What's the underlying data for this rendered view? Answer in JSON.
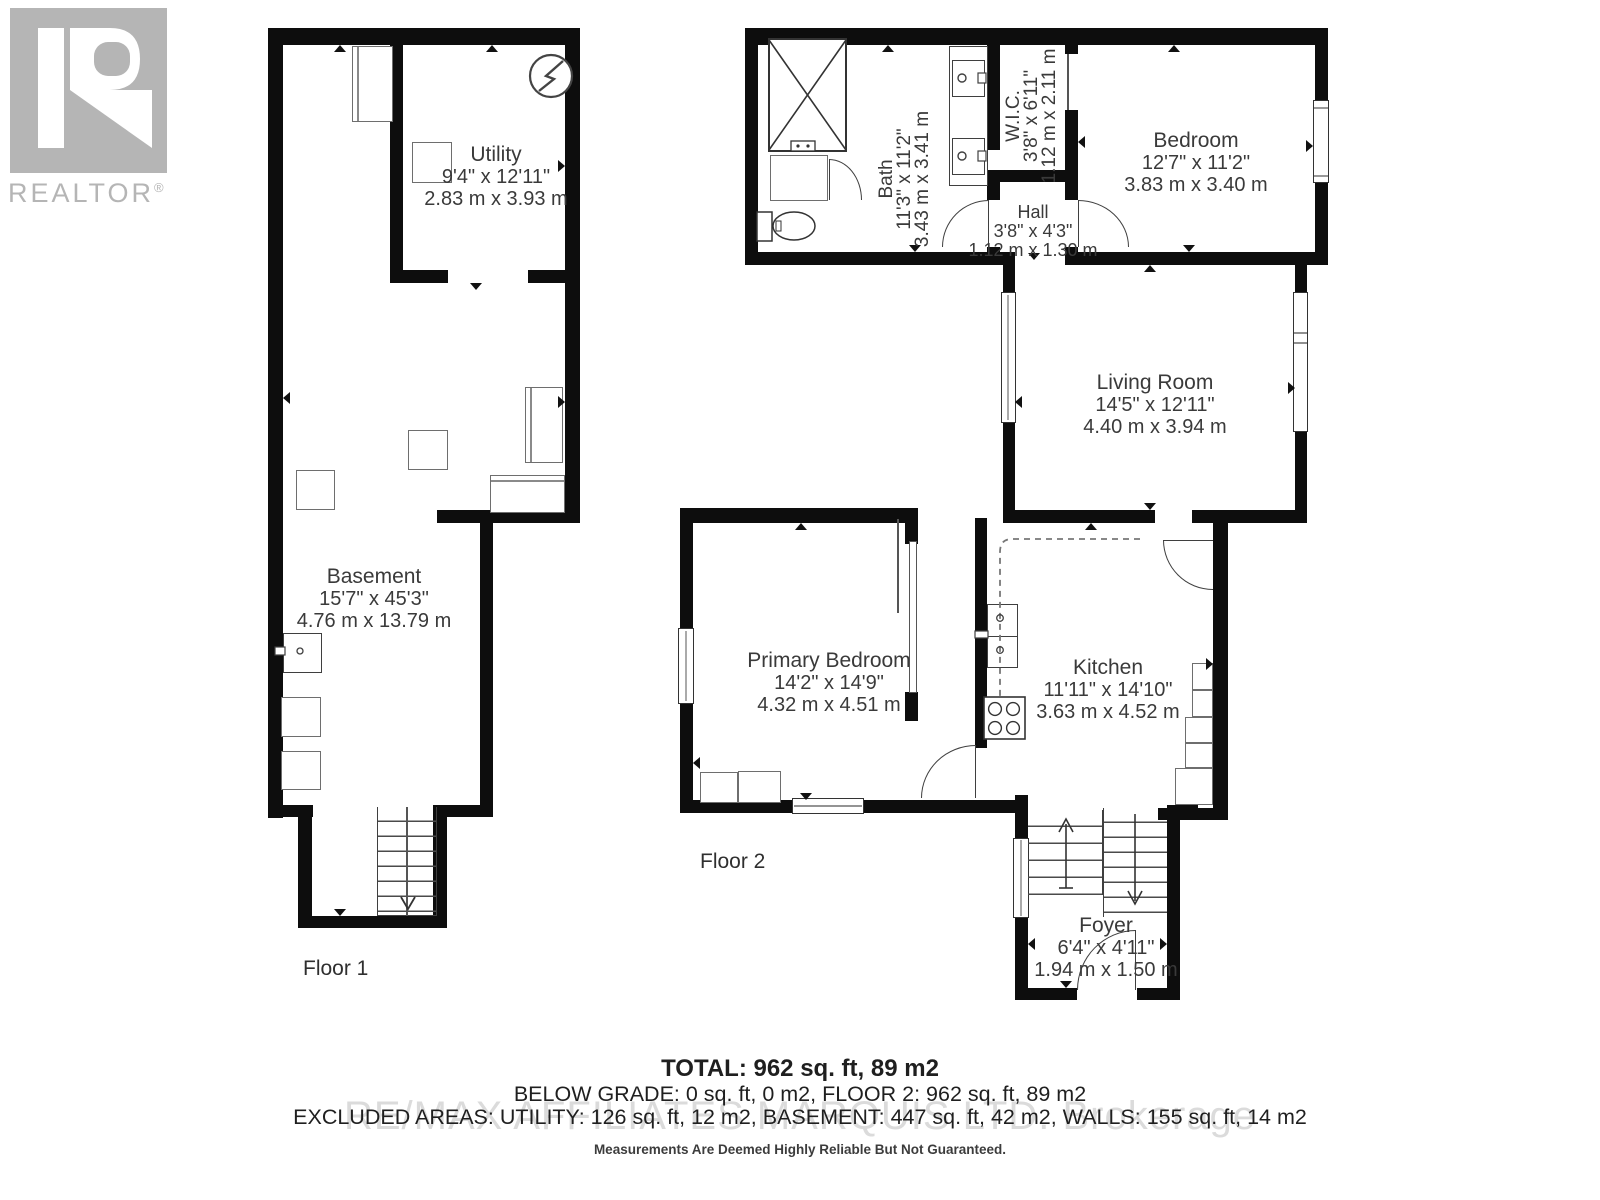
{
  "logo": {
    "wordmark": "REALTOR",
    "registered": "®"
  },
  "floor_labels": {
    "floor1": "Floor 1",
    "floor2": "Floor 2"
  },
  "rooms": {
    "utility": {
      "name": "Utility",
      "imperial": "9'4\" x 12'11\"",
      "metric": "2.83 m x 3.93 m"
    },
    "basement": {
      "name": "Basement",
      "imperial": "15'7\" x 45'3\"",
      "metric": "4.76 m x 13.79 m"
    },
    "bath": {
      "name": "Bath",
      "imperial": "11'3\" x 11'2\"",
      "metric": "3.43 m x 3.41 m"
    },
    "wic": {
      "name": "W.I.C.",
      "imperial": "3'8\" x 6'11\"",
      "metric": "1.12 m x 2.11 m"
    },
    "hall": {
      "name": "Hall",
      "imperial": "3'8\" x 4'3\"",
      "metric": "1.12 m x 1.30 m"
    },
    "bedroom": {
      "name": "Bedroom",
      "imperial": "12'7\" x 11'2\"",
      "metric": "3.83 m x 3.40 m"
    },
    "living": {
      "name": "Living Room",
      "imperial": "14'5\" x 12'11\"",
      "metric": "4.40 m x 3.94 m"
    },
    "primary": {
      "name": "Primary Bedroom",
      "imperial": "14'2\" x 14'9\"",
      "metric": "4.32 m x 4.51 m"
    },
    "kitchen": {
      "name": "Kitchen",
      "imperial": "11'11\" x 14'10\"",
      "metric": "3.63 m x 4.52 m"
    },
    "foyer": {
      "name": "Foyer",
      "imperial": "6'4\" x 4'11\"",
      "metric": "1.94 m x 1.50 m"
    }
  },
  "summary": {
    "total": "TOTAL: 962 sq. ft, 89 m2",
    "below_grade": "BELOW GRADE: 0 sq. ft, 0 m2, FLOOR 2: 962 sq. ft, 89 m2",
    "excluded": "EXCLUDED AREAS: UTILITY: 126 sq. ft, 12 m2, BASEMENT: 447 sq. ft, 42 m2, WALLS: 155 sq. ft, 14 m2",
    "watermark": "RE/MAX AFFILIATES MARQUIS LTD.  Brokerage",
    "disclaimer": "Measurements Are Deemed Highly Reliable But Not Guaranteed."
  },
  "icons": {
    "electrical_panel": "circle-with-bolt",
    "stairs_up": "arrow-up",
    "stairs_down": "arrow-down"
  },
  "colors": {
    "wall": "#0d0d0d",
    "fixture_stroke": "#3f3f3f",
    "label_text": "#3a3a3a",
    "logo_gray": "#b5b5b5",
    "watermark": "#c6c6c6"
  }
}
